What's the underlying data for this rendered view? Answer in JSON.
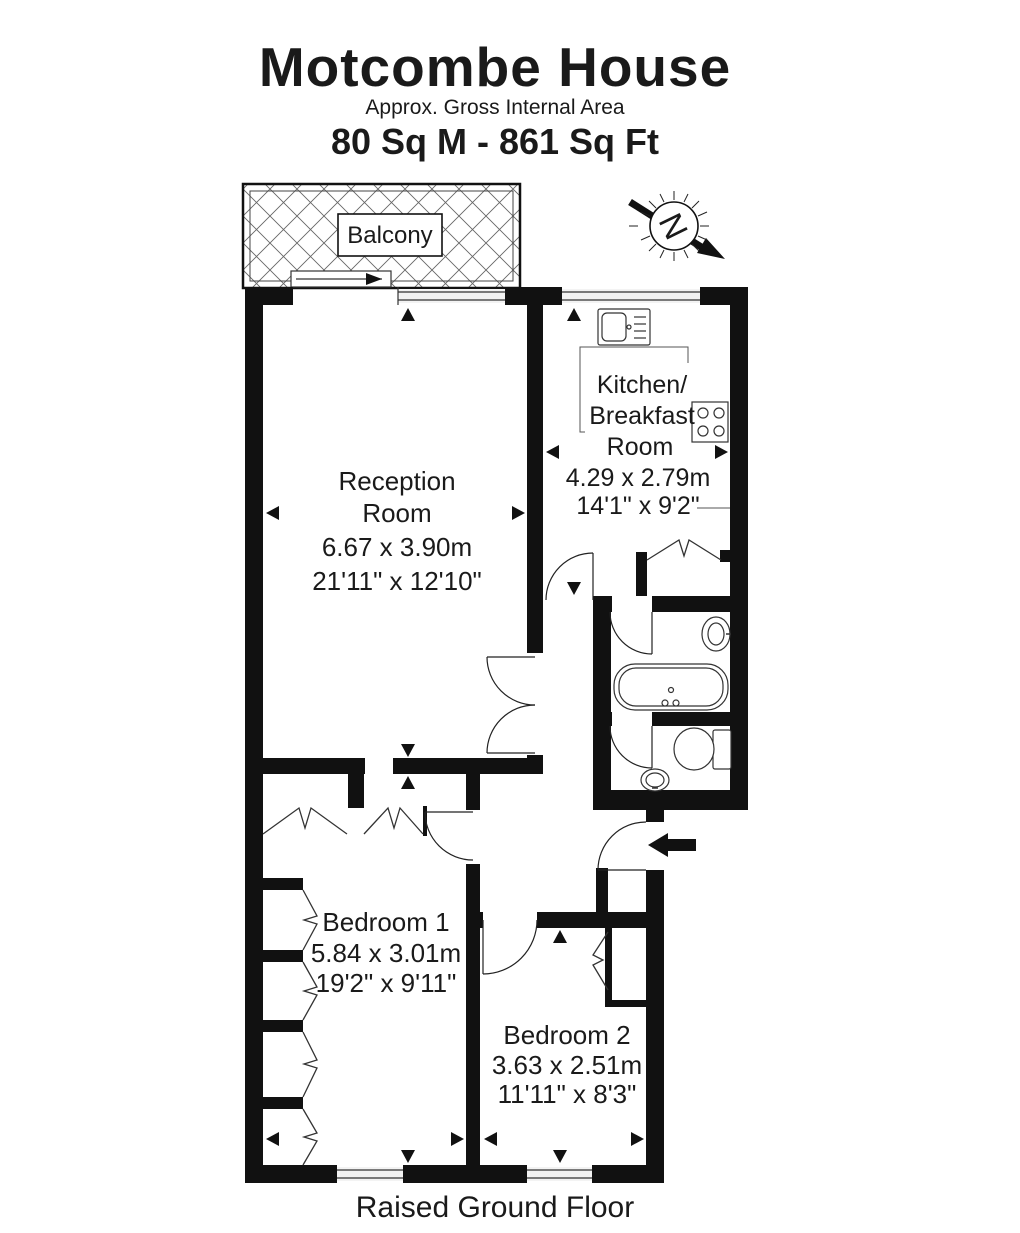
{
  "header": {
    "title": "Motcombe House",
    "subtitle": "Approx. Gross Internal Area",
    "area": "80 Sq M  -  861 Sq Ft"
  },
  "compass": {
    "label": "N"
  },
  "balcony": {
    "label": "Balcony"
  },
  "rooms": {
    "reception": {
      "name_line1": "Reception",
      "name_line2": "Room",
      "metric": "6.67 x 3.90m",
      "imperial": "21'11\" x 12'10\""
    },
    "kitchen": {
      "name_line1": "Kitchen/",
      "name_line2": "Breakfast",
      "name_line3": "Room",
      "metric": "4.29 x 2.79m",
      "imperial": "14'1\" x 9'2\""
    },
    "bedroom1": {
      "name": "Bedroom 1",
      "metric": "5.84 x 3.01m",
      "imperial": "19'2\" x 9'11\""
    },
    "bedroom2": {
      "name": "Bedroom 2",
      "metric": "3.63 x 2.51m",
      "imperial": "11'11\" x 8'3\""
    }
  },
  "footer": {
    "floor_label": "Raised Ground Floor"
  },
  "colors": {
    "wall": "#111111",
    "line": "#333333",
    "text": "#1a1a1a",
    "background": "#ffffff"
  }
}
